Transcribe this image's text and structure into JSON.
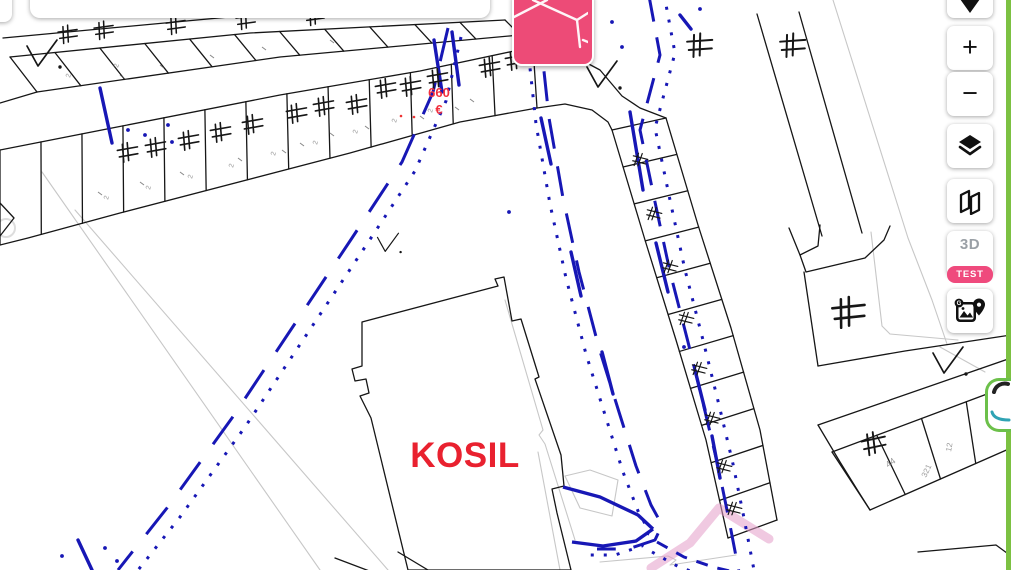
{
  "controls": {
    "zoom_in": "+",
    "zoom_out": "−",
    "threed_label": "3D",
    "test_label": "TEST",
    "icons": [
      "geolocate-icon",
      "layers-icon",
      "compare-maps-icon",
      "streetview-icon",
      "minimap-preview-icon"
    ]
  },
  "map": {
    "labels": {
      "building": "KOSIL",
      "price": "660",
      "currency": "€"
    },
    "parcel_texts": [
      {
        "t": "44",
        "x": 888,
        "y": 468,
        "r": -35,
        "s": 9
      },
      {
        "t": "321",
        "x": 926,
        "y": 478,
        "r": -65,
        "s": 8
      },
      {
        "t": "12",
        "x": 951,
        "y": 452,
        "r": -80,
        "s": 8
      }
    ],
    "twos": [
      [
        70,
        78
      ],
      [
        118,
        68
      ],
      [
        108,
        200
      ],
      [
        150,
        190
      ],
      [
        192,
        179
      ],
      [
        233,
        168
      ],
      [
        275,
        156
      ],
      [
        317,
        145
      ],
      [
        357,
        134
      ],
      [
        396,
        123
      ],
      [
        432,
        113
      ]
    ],
    "colors": {
      "line": "#161616",
      "faint": "#c7c7c7",
      "blue": "#1717b5",
      "building_red": "#e9212f",
      "price_red": "#f2303e",
      "pink_button": "#ed4b77",
      "badge_pink": "#ef4a7d",
      "pink_line": "rgba(227,157,200,0.55)",
      "green": "#7cc142",
      "teal": "#2fa3b4",
      "gray_text": "#8a8a8a"
    },
    "geometry": {
      "strips": [
        {
          "a": [
            [
              10,
              57
            ],
            [
              250,
              33
            ],
            [
              505,
              20
            ]
          ],
          "b": [
            [
              37,
              92
            ],
            [
              280,
              57
            ],
            [
              520,
              35
            ]
          ],
          "n": 11
        },
        {
          "a": [
            [
              0,
              150
            ],
            [
              280,
              95
            ],
            [
              420,
              71
            ],
            [
              533,
              47
            ]
          ],
          "b": [
            [
              0,
              245
            ],
            [
              28,
              238
            ],
            [
              120,
              213
            ],
            [
              350,
              153
            ],
            [
              460,
              122
            ],
            [
              537,
              108
            ]
          ],
          "n": 13
        },
        {
          "a": [
            [
              612,
              130
            ],
            [
              645,
              240
            ],
            [
              676,
              340
            ],
            [
              706,
              440
            ],
            [
              728,
              538
            ]
          ],
          "b": [
            [
              666,
              118
            ],
            [
              698,
              225
            ],
            [
              731,
              328
            ],
            [
              760,
              430
            ],
            [
              777,
              520
            ]
          ],
          "n": 11
        },
        {
          "a": [
            [
              832,
              452
            ],
            [
              1011,
              385
            ]
          ],
          "b": [
            [
              870,
              510
            ],
            [
              1011,
              448
            ]
          ],
          "n": 4
        }
      ],
      "black_lines": [
        [
          [
            3,
            38
          ],
          [
            240,
            16
          ]
        ],
        [
          [
            0,
            103
          ],
          [
            37,
            92
          ]
        ],
        [
          [
            0,
            203
          ],
          [
            14,
            218
          ],
          [
            0,
            236
          ]
        ],
        [
          [
            533,
            47
          ],
          [
            570,
            54
          ],
          [
            600,
            70
          ],
          [
            622,
            96
          ],
          [
            640,
            108
          ],
          [
            666,
            118
          ]
        ],
        [
          [
            537,
            108
          ],
          [
            565,
            104
          ],
          [
            592,
            110
          ],
          [
            608,
            122
          ],
          [
            612,
            130
          ]
        ],
        [
          [
            757,
            14
          ],
          [
            822,
            236
          ]
        ],
        [
          [
            799,
            12
          ],
          [
            862,
            233
          ]
        ],
        [
          [
            789,
            228
          ],
          [
            800,
            255
          ],
          [
            818,
            246
          ],
          [
            820,
            225
          ]
        ],
        [
          [
            800,
            255
          ],
          [
            806,
            272
          ],
          [
            865,
            258
          ],
          [
            884,
            240
          ],
          [
            890,
            226
          ]
        ],
        [
          [
            804,
            272
          ],
          [
            818,
            366
          ]
        ],
        [
          [
            818,
            425
          ],
          [
            1011,
            358
          ]
        ],
        [
          [
            335,
            558
          ],
          [
            372,
            572
          ]
        ],
        [
          [
            398,
            552
          ],
          [
            428,
            570
          ]
        ],
        [
          [
            918,
            552
          ],
          [
            996,
            545
          ],
          [
            1011,
            556
          ]
        ],
        [
          [
            818,
            425
          ],
          [
            840,
            462
          ],
          [
            858,
            491
          ],
          [
            870,
            510
          ]
        ],
        [
          [
            520,
            35
          ],
          [
            556,
            28
          ]
        ]
      ],
      "thick_lines": [
        [
          [
            818,
            366
          ],
          [
            905,
            351
          ],
          [
            1011,
            335
          ]
        ]
      ],
      "gray_lines": [
        [
          [
            42,
            172
          ],
          [
            320,
            570
          ]
        ],
        [
          [
            75,
            210
          ],
          [
            388,
            570
          ]
        ],
        [
          [
            833,
            0
          ],
          [
            908,
            238
          ],
          [
            932,
            300
          ],
          [
            947,
            344
          ]
        ],
        [
          [
            600,
            562
          ],
          [
            668,
            556
          ],
          [
            676,
            560
          ],
          [
            670,
            565
          ],
          [
            690,
            562
          ],
          [
            736,
            555
          ]
        ],
        [
          [
            538,
            452
          ],
          [
            560,
            570
          ]
        ],
        [
          [
            940,
            347
          ],
          [
            985,
            372
          ]
        ],
        [
          [
            871,
            232
          ],
          [
            882,
            326
          ],
          [
            890,
            334
          ],
          [
            958,
            340
          ]
        ],
        [
          [
            505,
            300
          ],
          [
            543,
            430
          ],
          [
            539,
            435
          ],
          [
            545,
            444
          ],
          [
            575,
            540
          ]
        ],
        [
          [
            565,
            476
          ],
          [
            580,
            508
          ],
          [
            612,
            516
          ],
          [
            618,
            480
          ],
          [
            590,
            470
          ],
          [
            565,
            476
          ]
        ]
      ],
      "kosil_path": "M362,322 L498,286 L495,279 L504,277 L512,321 L521,319 L539,377 L535,379 L561,455 L564,486 L552,489 L557,513 L571,570 L408,570 L371,418 L360,396 L369,393 L366,379 L355,381 L352,369 L362,366 Z",
      "corridors": [
        {
          "pts": [
            [
              448,
              28
            ],
            [
              433,
              92
            ],
            [
              402,
              162
            ],
            [
              352,
              238
            ],
            [
              292,
              328
            ],
            [
              232,
              418
            ],
            [
              167,
              508
            ],
            [
              118,
              570
            ]
          ],
          "dash": "34 22",
          "off": [
            13,
            9
          ]
        },
        {
          "pts": [
            [
              536,
              24
            ],
            [
              543,
              62
            ],
            [
              549,
              118
            ],
            [
              563,
              198
            ],
            [
              579,
              272
            ],
            [
              599,
              348
            ],
            [
              619,
              412
            ],
            [
              636,
              466
            ],
            [
              651,
              505
            ],
            [
              662,
              525
            ],
            [
              655,
              540
            ],
            [
              628,
              549
            ],
            [
              597,
              549
            ]
          ],
          "dash": "30 18",
          "off": [
            -13,
            6
          ]
        },
        {
          "pts": [
            [
              657,
              542
            ],
            [
              684,
              557
            ],
            [
              713,
              567
            ],
            [
              742,
              574
            ]
          ],
          "dash": "12 10",
          "off": [
            -5,
            10
          ]
        },
        {
          "pts": [
            [
              649,
              -4
            ],
            [
              660,
              55
            ],
            [
              640,
              130
            ],
            [
              655,
              202
            ],
            [
              670,
              272
            ],
            [
              688,
              342
            ],
            [
              704,
              407
            ],
            [
              718,
              466
            ],
            [
              729,
              520
            ],
            [
              739,
              572
            ]
          ],
          "dash": "26 16",
          "off": [
            15,
            -2
          ]
        }
      ],
      "blue_solids": [
        [
          [
            563,
            487
          ],
          [
            600,
            497
          ],
          [
            638,
            515
          ],
          [
            653,
            529
          ]
        ],
        [
          [
            653,
            529
          ],
          [
            636,
            541
          ],
          [
            603,
            546
          ],
          [
            572,
            542
          ]
        ]
      ],
      "blue_accents": [
        [
          434,
          40,
          442,
          92
        ],
        [
          452,
          32,
          459,
          85
        ],
        [
          541,
          118,
          551,
          164
        ],
        [
          571,
          252,
          581,
          296
        ],
        [
          602,
          352,
          613,
          394
        ],
        [
          630,
          112,
          643,
          190
        ],
        [
          656,
          243,
          668,
          292
        ],
        [
          695,
          370,
          705,
          410
        ],
        [
          712,
          436,
          720,
          478
        ],
        [
          100,
          88,
          112,
          143
        ],
        [
          680,
          15,
          691,
          29
        ],
        [
          78,
          540,
          92,
          570
        ]
      ],
      "blue_dots": [
        [
          509,
          212
        ],
        [
          684,
          347
        ],
        [
          612,
          22
        ],
        [
          622,
          47
        ],
        [
          105,
          548
        ],
        [
          117,
          561
        ],
        [
          62,
          556
        ],
        [
          700,
          9
        ],
        [
          519,
          30
        ],
        [
          527,
          43
        ],
        [
          128,
          130
        ],
        [
          145,
          135
        ],
        [
          168,
          125
        ],
        [
          172,
          142
        ]
      ],
      "pink_line": {
        "pts": [
          [
            651,
            568
          ],
          [
            690,
            543
          ],
          [
            719,
            508
          ],
          [
            769,
            539
          ]
        ],
        "w": 9
      },
      "neq_marks": [
        [
          68,
          34,
          0.8,
          -8
        ],
        [
          104,
          30,
          0.8,
          -8
        ],
        [
          176,
          25,
          0.8,
          -8
        ],
        [
          246,
          20,
          0.8,
          -8
        ],
        [
          315,
          16,
          0.8,
          -8
        ],
        [
          128,
          152,
          0.85,
          -10
        ],
        [
          156,
          147,
          0.85,
          -10
        ],
        [
          189,
          140,
          0.85,
          -10
        ],
        [
          221,
          132,
          0.85,
          -10
        ],
        [
          253,
          124,
          0.85,
          -10
        ],
        [
          297,
          113,
          0.85,
          -10
        ],
        [
          324,
          106,
          0.85,
          -10
        ],
        [
          357,
          104,
          0.85,
          -10
        ],
        [
          386,
          88,
          0.85,
          -10
        ],
        [
          411,
          86,
          0.85,
          -10
        ],
        [
          438,
          78,
          0.85,
          -10
        ],
        [
          490,
          67,
          0.85,
          -10
        ],
        [
          516,
          60,
          0.85,
          -10
        ],
        [
          640,
          160,
          0.62,
          14
        ],
        [
          654,
          214,
          0.62,
          14
        ],
        [
          670,
          267,
          0.62,
          14
        ],
        [
          686,
          319,
          0.62,
          14
        ],
        [
          699,
          369,
          0.62,
          14
        ],
        [
          712,
          419,
          0.62,
          14
        ],
        [
          724,
          467,
          0.62,
          14
        ],
        [
          734,
          509,
          0.62,
          14
        ],
        [
          700,
          45,
          1.05,
          -4
        ],
        [
          793,
          45,
          1.05,
          -4
        ],
        [
          849,
          312,
          1.35,
          -6
        ],
        [
          874,
          443,
          1.0,
          -12
        ]
      ],
      "check_marks": [
        [
          42,
          54,
          1
        ],
        [
          602,
          75,
          1
        ],
        [
          388,
          243,
          0.7
        ],
        [
          948,
          361,
          1
        ]
      ],
      "red_dots": [
        [
          401,
          116
        ],
        [
          414,
          117
        ]
      ],
      "specks": [
        [
          238,
          158
        ],
        [
          300,
          143
        ],
        [
          330,
          133
        ],
        [
          365,
          126
        ],
        [
          282,
          150
        ],
        [
          180,
          172
        ],
        [
          140,
          182
        ],
        [
          98,
          192
        ],
        [
          420,
          116
        ],
        [
          455,
          107
        ],
        [
          470,
          99
        ],
        [
          120,
          75
        ],
        [
          160,
          65
        ],
        [
          210,
          55
        ],
        [
          262,
          47
        ],
        [
          330,
          40
        ]
      ]
    }
  }
}
